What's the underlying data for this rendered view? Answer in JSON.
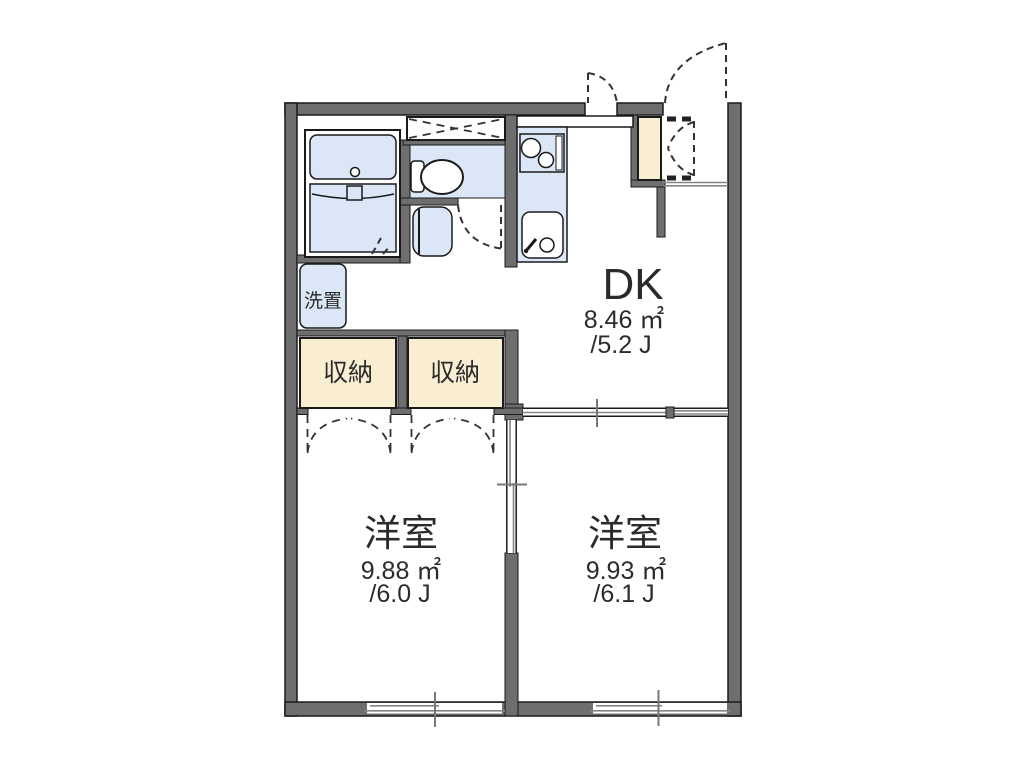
{
  "floorplan": {
    "rooms": {
      "dk": {
        "label": "DK",
        "area_m2": "8.46 ㎡",
        "area_tatami": "/5.2 J"
      },
      "bedroom_left": {
        "label": "洋室",
        "area_m2": "9.88 ㎡",
        "area_tatami": "/6.0 J"
      },
      "bedroom_right": {
        "label": "洋室",
        "area_m2": "9.93 ㎡",
        "area_tatami": "/6.1 J"
      }
    },
    "storage": {
      "closet_left": "収納",
      "closet_right": "収納",
      "laundry": "洗置"
    },
    "colors": {
      "wall": "#6e6e6e",
      "line": "#1a1a1a",
      "fixture": "#dbe6f6",
      "storage": "#faeed2",
      "detail": "#858585"
    }
  }
}
